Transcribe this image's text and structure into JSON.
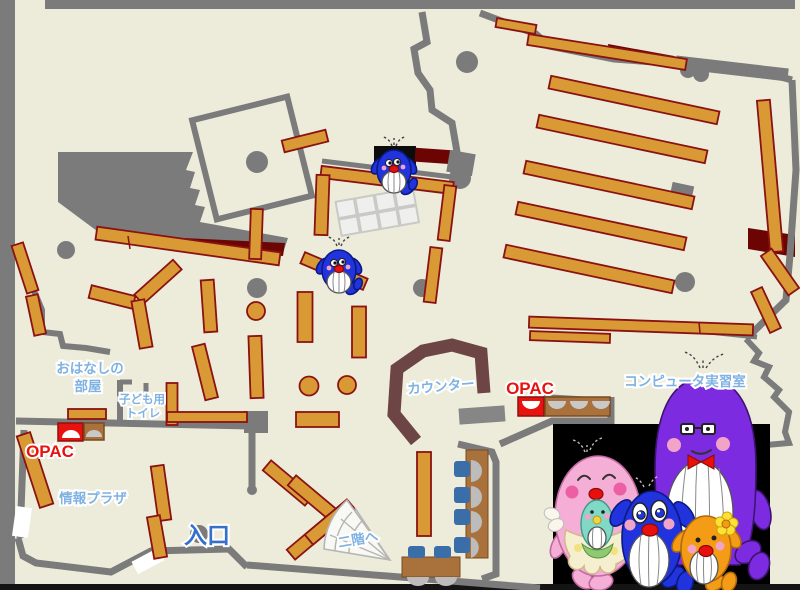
{
  "labels": {
    "storytelling_room_line1": "おはなしの",
    "storytelling_room_line2": "部屋",
    "kids_toilet_line1": "子ども用",
    "kids_toilet_line2": "トイレ",
    "opac_left": "OPAC",
    "opac_right": "OPAC",
    "info_plaza": "情報プラザ",
    "entrance": "入口",
    "to_second_floor": "二階へ",
    "counter": "カウンター",
    "computer_room": "コンピュータ実習室"
  },
  "colors": {
    "floor": "#edecdb",
    "wall": "#7b7b7b",
    "frame_black": "#141414",
    "shelf": "#d99a36",
    "shelf_border": "#8a1212",
    "dark_red": "#6d0404",
    "counter": "#6d4545",
    "table_brown": "#a9713c",
    "chair_blue": "#3a6ea8",
    "seat_gray": "#bcbcbc",
    "label_blue": "#7fb2e2",
    "entrance_blue": "#3570cd",
    "opac_red": "#e8120e",
    "stairs_fill": "#f8f8f5",
    "grid_fill": "#efefed",
    "photo_bg": "#000000",
    "whale_blue": "#2033dd",
    "whale_purple": "#7d2be0",
    "whale_pink": "#f5aed6",
    "whale_orange": "#f59c17",
    "whale_baby_green": "#7fd9c4"
  },
  "characters": {
    "map_mascots": [
      "blue-whale-small",
      "blue-whale-small"
    ],
    "family": [
      "pink-mother-whale-with-baby",
      "blue-boy-whale",
      "purple-father-whale-glasses-bowtie",
      "orange-girl-whale-flower"
    ]
  }
}
